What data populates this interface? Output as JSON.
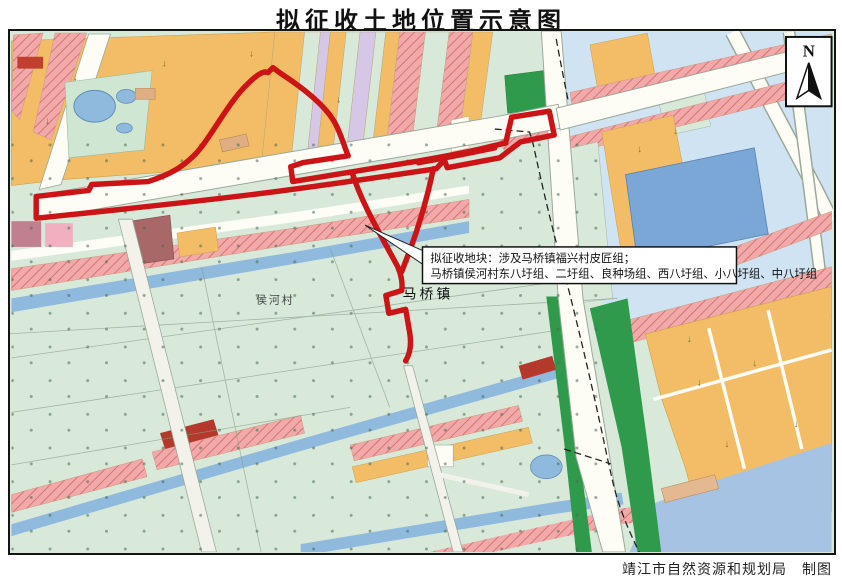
{
  "title": "拟征收土地位置示意图",
  "map": {
    "north_label": "N",
    "town_label": "马桥镇",
    "village_label": "侯河村",
    "annotation_line1": "拟征收地块：涉及马桥镇福兴村皮匠组；",
    "annotation_line2": "马桥镇侯河村东八圩组、二圩组、良种场组、西八圩组、小八圩组、中八圩组",
    "credit": "靖江市自然资源和规划局　制图"
  },
  "colors": {
    "boundary_red": "#cc1417",
    "parcel_orange": "#f2bd66",
    "parcel_mint": "#d8e9da",
    "parcel_pink": "#f2a9a9",
    "hatch_line": "#cf6e6e",
    "water_blue": "#8fb9dd",
    "water_light": "#a6c3e4",
    "forest_green": "#2f9a4c",
    "parcel_blue": "#7aa7d6",
    "parcel_lavender": "#d7c7e7",
    "building_red": "#b4392c",
    "building_tan": "#dfae82",
    "road_white": "#fdfdf6"
  }
}
